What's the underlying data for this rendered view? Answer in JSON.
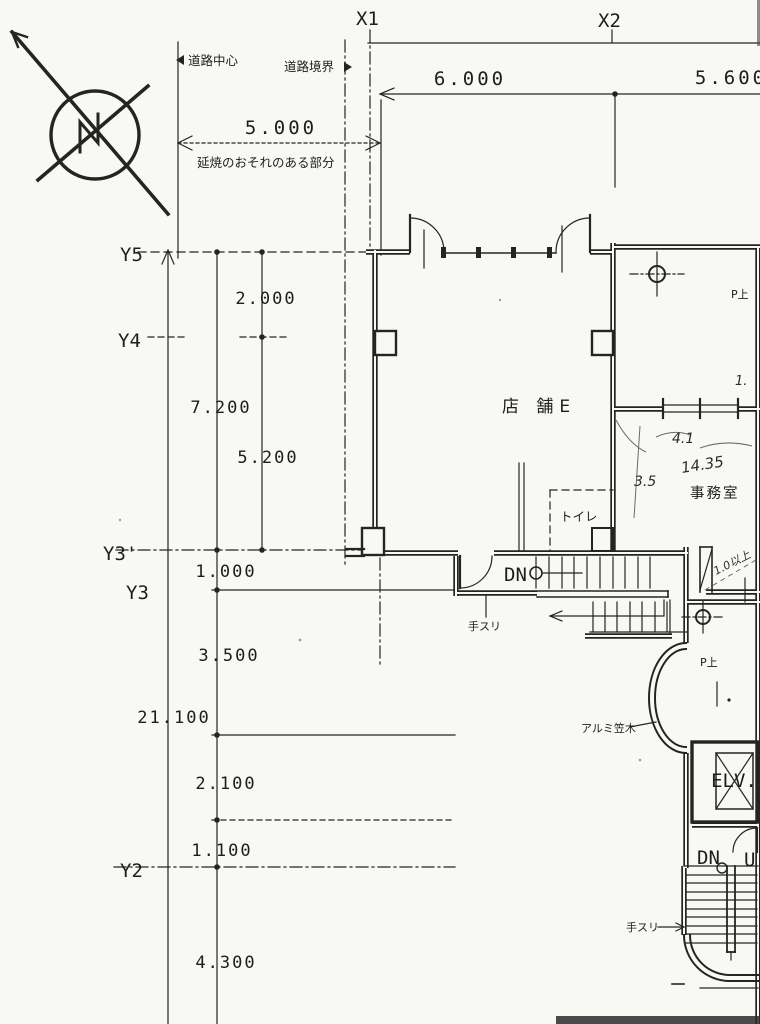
{
  "colors": {
    "ink": "#242424",
    "paper": "#f8f8f5",
    "pencil": "#6b6b6b"
  },
  "grid": {
    "x1": "X1",
    "x2": "X2",
    "y5": "Y5",
    "y4": "Y4",
    "y3_dash": "Y3'",
    "y3": "Y3",
    "y2": "Y2"
  },
  "dimensions": {
    "fire_offset": "5.000",
    "bay_x1_x2": "6.000",
    "bay_x2_x3": "5.600",
    "left": [
      "2.000",
      "7.200",
      "5.200",
      "1.000",
      "3.500",
      "21.100",
      "2.100",
      "1.100",
      "4.300"
    ]
  },
  "labels": {
    "road_center": "道路中心",
    "road_boundary": "道路境界",
    "fire_spread": "延焼のおそれのある部分",
    "shop": "店 舗E",
    "office": "事務室",
    "toilet": "トイレ",
    "handrail": "手スリ",
    "handrail2": "手スリ",
    "aluminum_coping": "アルミ笠木",
    "dn": "DN",
    "dn2": "DN",
    "up": "U",
    "elevator": "ELV.",
    "pipe_up": "P上",
    "pipe_up2": "P上"
  },
  "hand_notes": {
    "office_width": "4.1",
    "office_area": "14.35",
    "office_depth": "3.5",
    "clearance": "1.0以上",
    "edge_dim": "1."
  }
}
